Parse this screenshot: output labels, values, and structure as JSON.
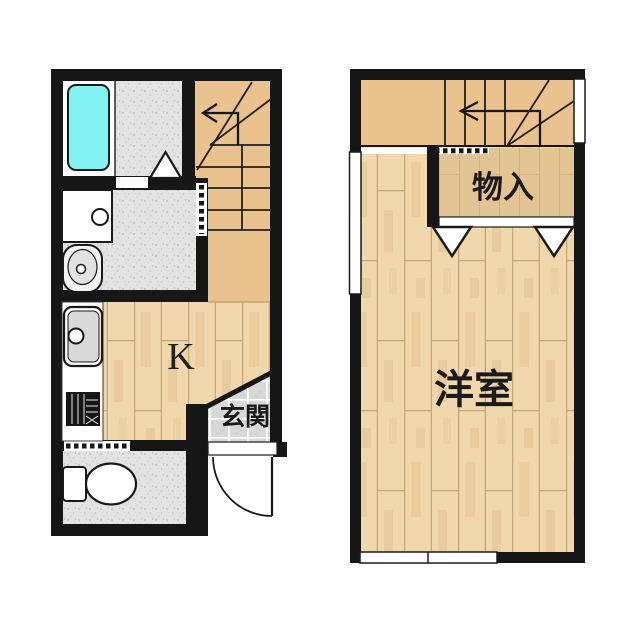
{
  "plan": {
    "floor1": {
      "kitchen_label": "K",
      "entrance_label": "玄関"
    },
    "floor2": {
      "closet_label": "物入",
      "room_label": "洋室"
    },
    "colors": {
      "background": "#ffffff",
      "wall": "#161616",
      "stair_floor": "#e9c28d",
      "closet_floor": "#e2c globalization",
      "wood_floor": "#f0d7ac",
      "tile_floor": "#e3e3e3",
      "entrance_tile": "#d8d8d8",
      "bathtub": "#82f2f2"
    }
  }
}
